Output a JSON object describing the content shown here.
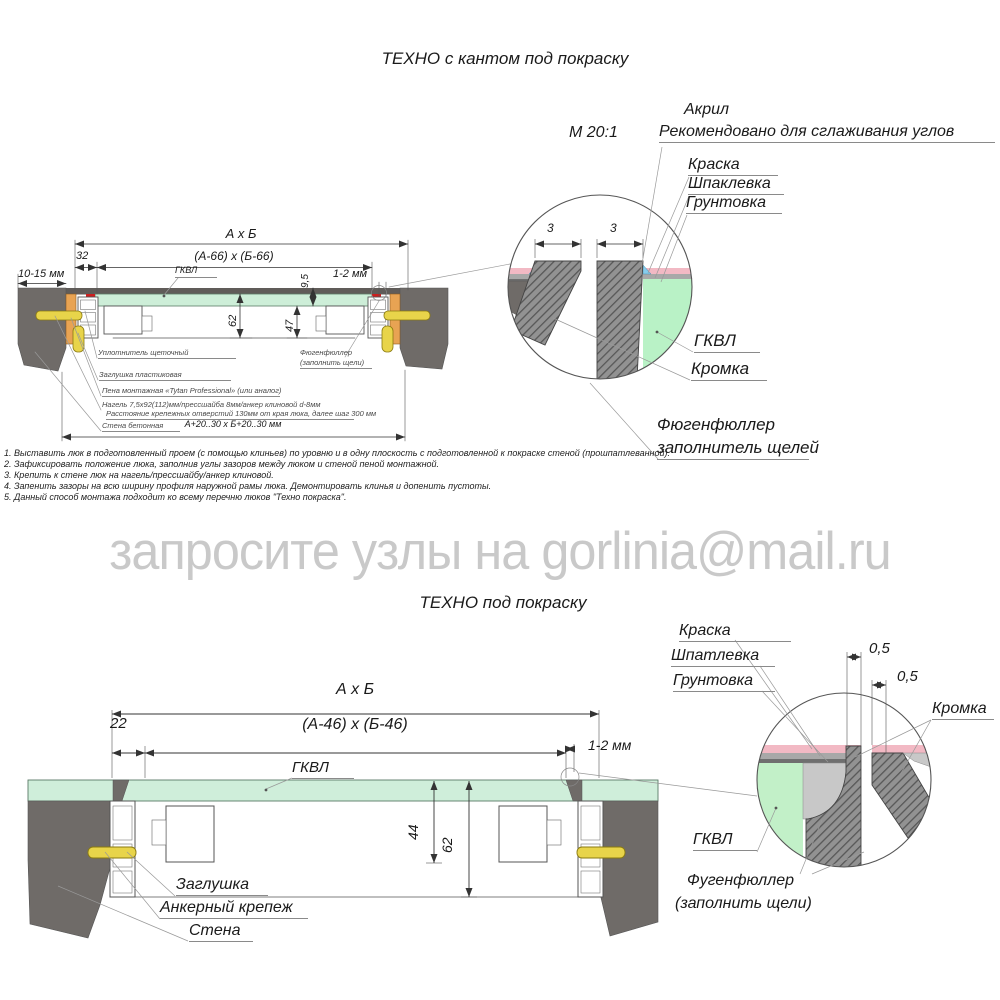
{
  "page": {
    "title_top": "ТЕХНО с кантом под покраску",
    "title_bottom": "ТЕХНО под покраску",
    "watermark": "запросите узлы на gorlinia@mail.ru",
    "scale": "М 20:1"
  },
  "top": {
    "dims": {
      "overall": "А х Б",
      "opening": "(А-66) х (Б-66)",
      "offset32": "32",
      "wall_gap": "10-15 мм",
      "panel_thickness": "9,5",
      "edge_gap": "1-2 мм",
      "depth_total": "62",
      "depth_inner": "47",
      "proem": "А+20..30 х Б+20..30 мм"
    },
    "labels": {
      "gkvl": "ГКВЛ",
      "seal": "Уплотнитель щеточный",
      "plug": "Заглушка пластиковая",
      "foam": "Пена монтажная «Tytan Professional» (или аналог)",
      "fastener": "Нагель 7,5х92(112)мм/прессшайба 8мм/анкер клиновой d-8мм",
      "spacing": "Расстояние крепежных отверстий 130мм от края люка, далее шаг 300 мм",
      "wall": "Стена бетонная",
      "filler1": "Фюгенфюллер",
      "filler2": "(заполнить щели)"
    },
    "detail": {
      "gap_left": "3",
      "gap_right": "3",
      "acryl": "Акрил",
      "acryl_note": "Рекомендовано для сглаживания углов",
      "paint": "Краска",
      "putty": "Шпаклевка",
      "primer": "Грунтовка",
      "gkvl": "ГКВЛ",
      "edge": "Кромка",
      "filler1": "Фюгенфюллер",
      "filler2": "заполнитель щелей"
    }
  },
  "notes": [
    "1. Выставить люк в подготовленный проем (с помощью клиньев) по уровню и в одну плоскость с подготовленной к покраске стеной (прошпатлеванной).",
    "2. Зафиксировать положение люка, заполнив углы зазоров между люком и стеной пеной монтажной.",
    "3. Крепить к стене люк на нагель/прессшайбу/анкер клиновой.",
    "4. Запенить зазоры на всю ширину профиля наружной рамы люка. Демонтировать клинья и допенить пустоты.",
    "5. Данный способ монтажа подходит ко всему перечню люков \"Техно покраска\"."
  ],
  "bottom": {
    "dims": {
      "overall": "А х Б",
      "opening": "(А-46) х (Б-46)",
      "offset22": "22",
      "edge_gap": "1-2 мм",
      "depth_inner": "44",
      "depth_total": "62"
    },
    "labels": {
      "gkvl": "ГКВЛ",
      "plug": "Заглушка",
      "anchor": "Анкерный крепеж",
      "wall": "Стена"
    },
    "detail": {
      "paint": "Краска",
      "putty": "Шпатлевка",
      "primer": "Грунтовка",
      "gap1": "0,5",
      "gap2": "0,5",
      "edge": "Кромка",
      "gkvl": "ГКВЛ",
      "filler1": "Фугенфюллер",
      "filler2": "(заполнить щели)"
    }
  },
  "colors": {
    "wall": "#6f6b68",
    "gkvl_green": "#cdeed8",
    "wedge_orange": "#e8a353",
    "anchor_yellow": "#e8d44a",
    "seal_red": "#cc1f1f",
    "paint_pink": "#f2b9c4",
    "acryl_blue": "#86ccec",
    "watermark_gray": "#c9c9c9"
  }
}
